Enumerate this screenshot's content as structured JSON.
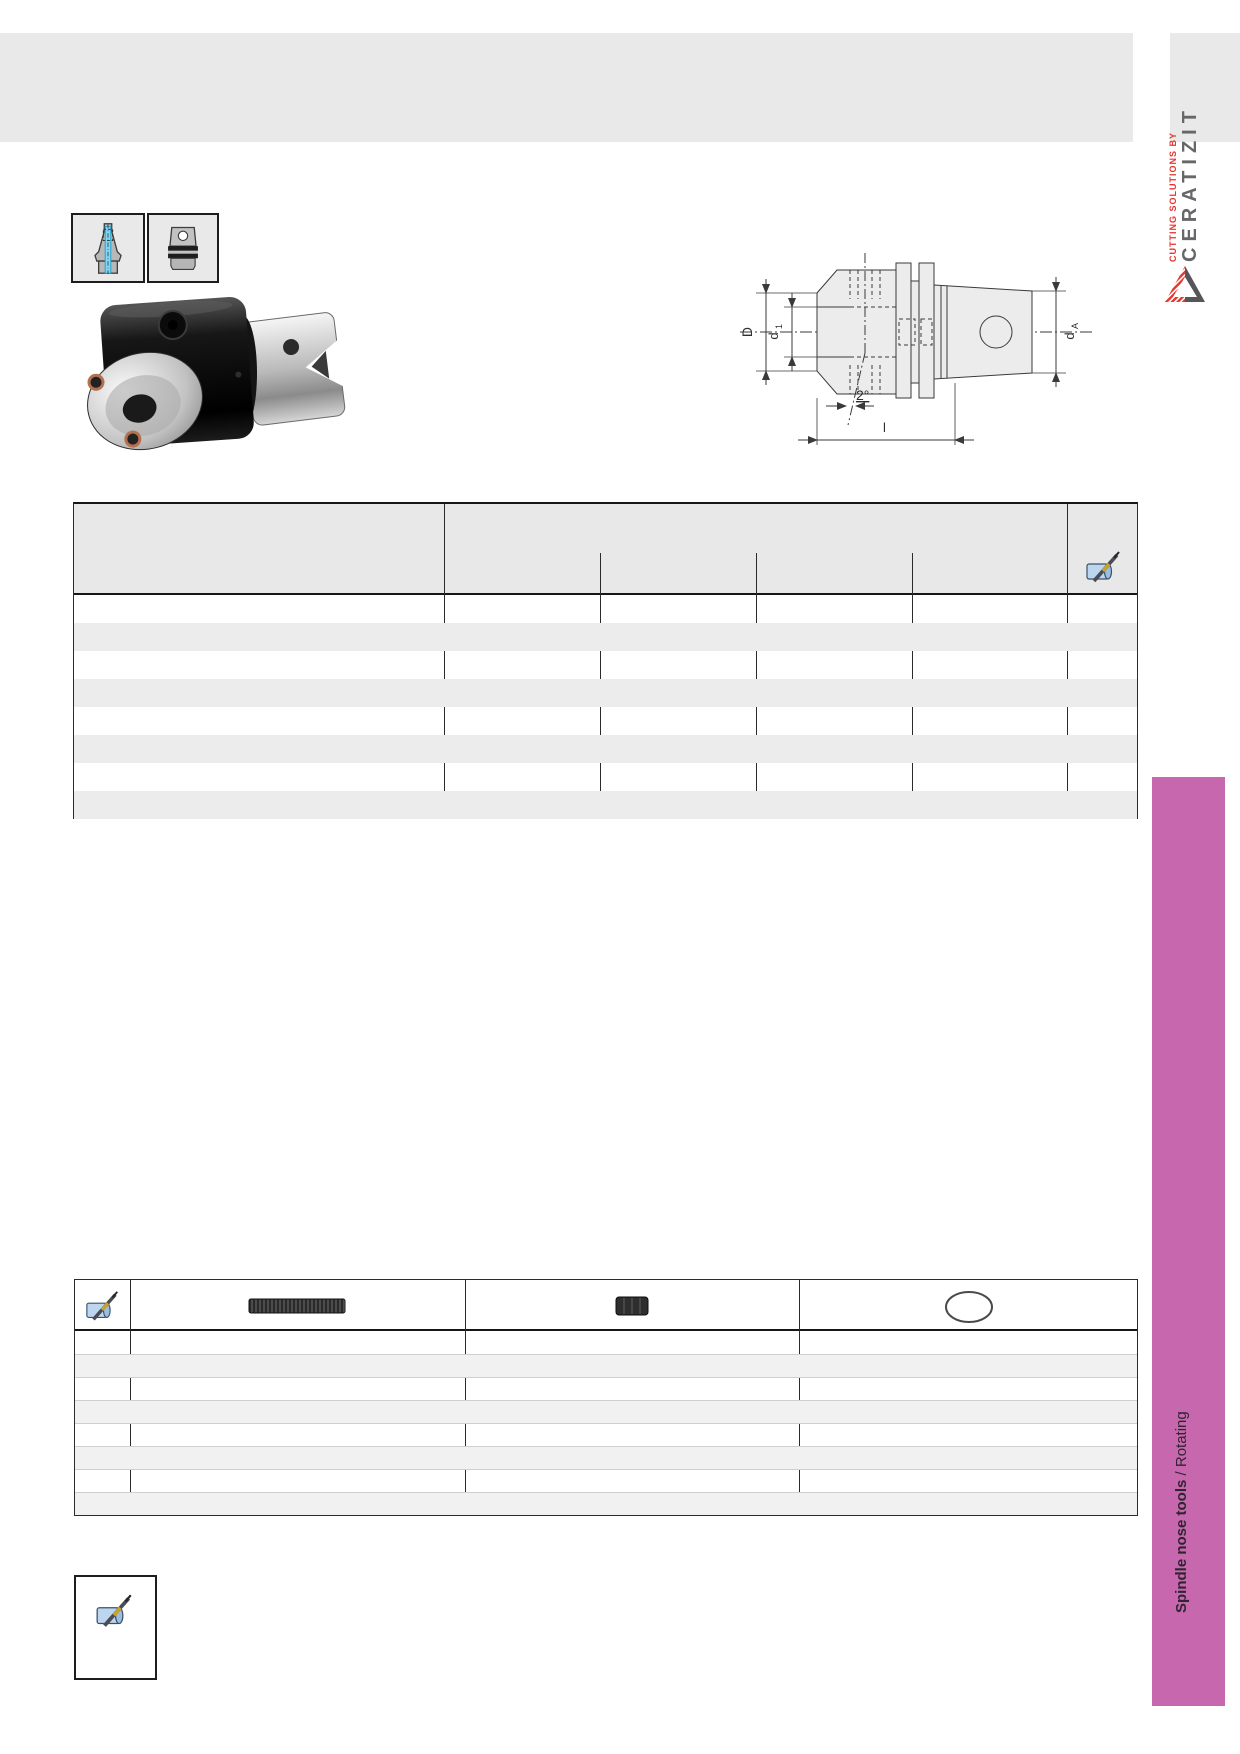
{
  "brand": {
    "tagline": "CUTTING SOLUTIONS BY",
    "name": "CERATIZIT",
    "tagline_color": "#e6352e",
    "name_color": "#67676b"
  },
  "header": {
    "band_color": "#e9e9e9"
  },
  "type_icons": [
    {
      "name": "taper-shank-tool-icon",
      "coolant_color": "#7fd8f5"
    },
    {
      "name": "spindle-adapter-icon"
    }
  ],
  "drawing": {
    "dim_D": "D",
    "dim_d1_base": "d",
    "dim_d1_sub": "1",
    "dim_dA_base": "d",
    "dim_dA_sub": "A",
    "angle_label": "2°",
    "length_label": "l"
  },
  "main_table": {
    "row_count": 8,
    "column_count": 5,
    "header_icon": "tool-assembly-icon",
    "cells_empty": true
  },
  "accessories_table": {
    "row_count": 8,
    "header_icon": "tool-assembly-icon",
    "column_images": [
      "threaded-stud",
      "set-screw",
      "o-ring"
    ],
    "cells_empty": true
  },
  "note_box": {
    "icon": "tool-assembly-icon"
  },
  "sidebar": {
    "bar_color": "#c767ad",
    "label_bold": "Spindle nose tools",
    "label_regular": " / Rotating"
  }
}
